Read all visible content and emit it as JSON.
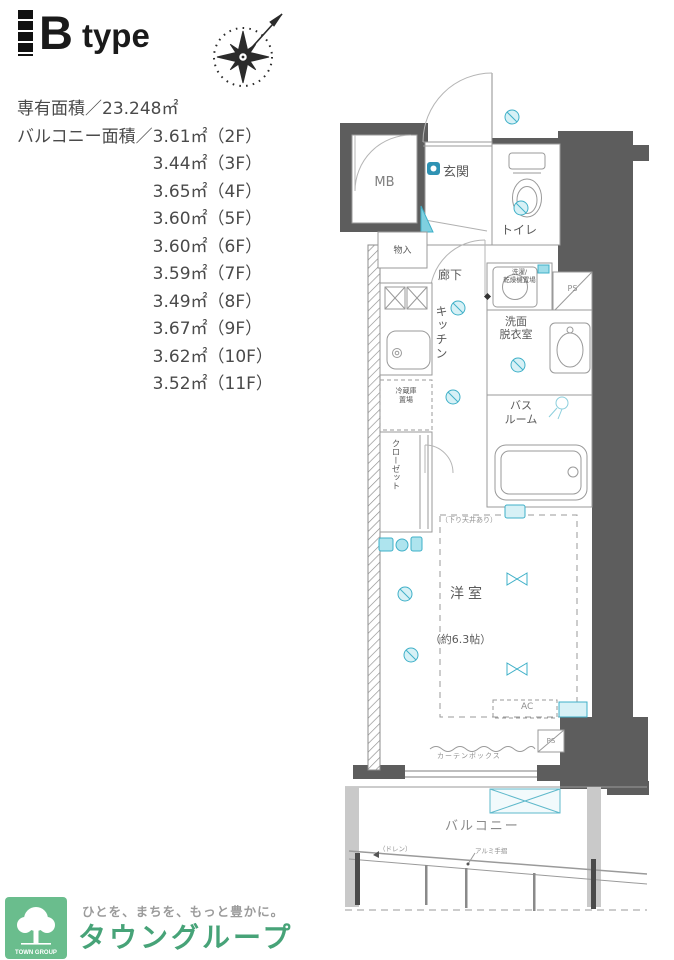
{
  "header": {
    "type_label": "B type",
    "type_letter": "B",
    "type_word": "type"
  },
  "area_info": {
    "exclusive": "専有面積／23.248㎡",
    "balcony_prefix": "バルコニー面積／",
    "balcony_entries": [
      "3.61㎡（2F）",
      "3.44㎡（3F）",
      "3.65㎡（4F）",
      "3.60㎡（5F）",
      "3.60㎡（6F）",
      "3.59㎡（7F）",
      "3.49㎡（8F）",
      "3.67㎡（9F）",
      "3.62㎡（10F）",
      "3.52㎡（11F）"
    ]
  },
  "floorplan": {
    "rooms": {
      "mb": "MB",
      "genkan": "玄関",
      "toilet": "トイレ",
      "monoire": "物入",
      "hallway": "廊下",
      "kitchen": "キッチン",
      "washer_line1": "洗濯/",
      "washer_line2": "乾燥機置場",
      "ps_top": "PS",
      "washroom_line1": "洗面",
      "washroom_line2": "脱衣室",
      "bathroom_line1": "バス",
      "bathroom_line2": "ルーム",
      "closet": "クローゼット",
      "fridge_line1": "冷蔵庫",
      "fridge_line2": "置場",
      "western_room": "洋室",
      "western_room_size": "（約6.3帖）",
      "balcony": "バルコニー"
    },
    "annotations": {
      "ceiling_note": "（下り天井あり）",
      "ac": "AC",
      "ps_bottom": "PS",
      "curtain_box": "カーテンボックス",
      "drain": "（ドレン）",
      "handrail": "アルミ手摺"
    }
  },
  "footer": {
    "logo_text": "TOWN GROUP",
    "tagline": "ひとを、まちを、もっと豊かに。",
    "brand": "タウングループ"
  },
  "colors": {
    "wall": "#5d5d5d",
    "line": "#9a9a9a",
    "accent_cyan": "#4db8cd",
    "logo_green": "#6abd8d",
    "brand_green": "#47a378"
  }
}
